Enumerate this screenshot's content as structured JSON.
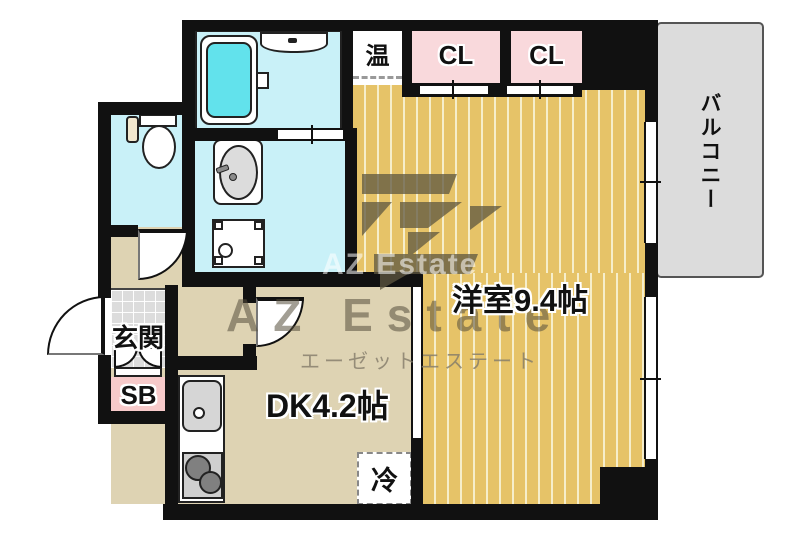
{
  "floorplan": {
    "labels": {
      "western_room": "洋室9.4帖",
      "dining_kitchen": "DK4.2帖",
      "entrance": "玄関",
      "shoe_box": "SB",
      "closet_1": "CL",
      "closet_2": "CL",
      "balcony": "バルコニー",
      "water_heater": "温",
      "refrigerator": "冷"
    },
    "watermark": {
      "logo_text": "AZ",
      "brand_faint": "AZ Estate",
      "brand_large": "AZ Estate",
      "brand_kana": "エーゼットエステート"
    },
    "colors": {
      "wall": "#111111",
      "wet_room_floor": "#c9f1f8",
      "bathtub": "#62e2ec",
      "closet_pink": "#f9d9dc",
      "shoe_box_pink": "#f7caca",
      "dk_floor": "#ded3b3",
      "wood_floor": "#e6c368",
      "wood_stripe": "#f6eecb",
      "balcony_floor": "#dcdcdc",
      "entrance_tile": "#dcdcdc"
    }
  }
}
